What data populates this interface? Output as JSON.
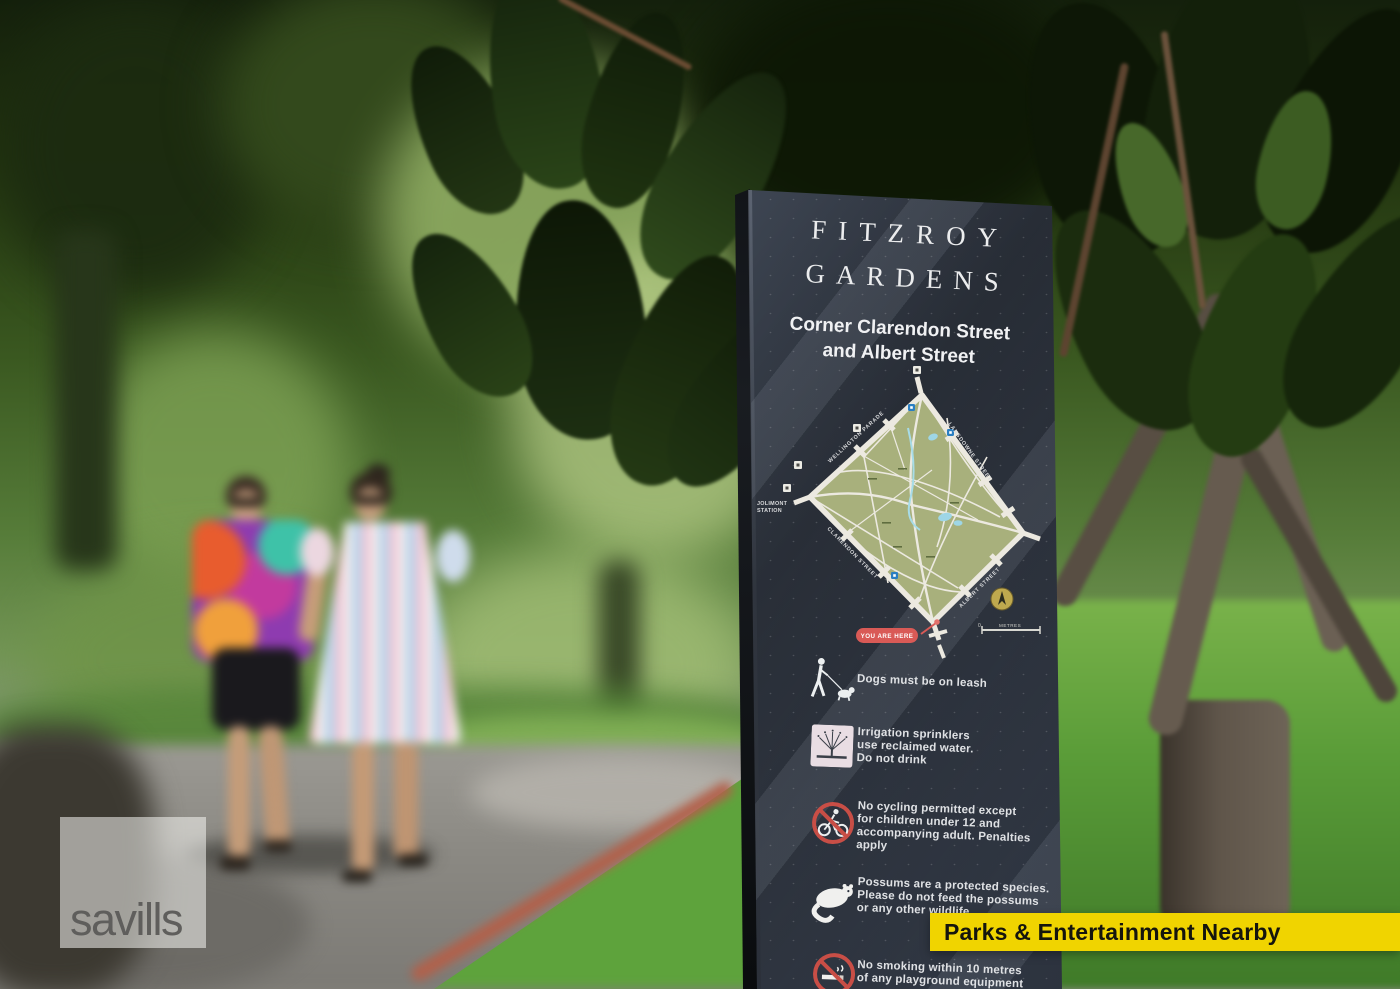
{
  "banner": {
    "label": "Parks & Entertainment Nearby",
    "bg_color": "#F0D400",
    "text_color": "#15150D"
  },
  "watermark": {
    "label": "savills"
  },
  "sign": {
    "panel_color": "#3E4654",
    "title_line1": "FITZROY",
    "title_line2": "GARDENS",
    "subtitle_line1": "Corner Clarendon Street",
    "subtitle_line2": "and Albert Street",
    "map": {
      "park_fill_color": "#A8B07C",
      "path_color": "#ECE9E0",
      "marker_color": "#D95A56",
      "street_labels": {
        "top_left": "WELLINGTON PARADE",
        "top_right": "LANSDOWNE STREET",
        "bottom_left": "CLARENDON STREET",
        "bottom_right": "ALBERT STREET"
      },
      "station_line1": "JOLIMONT",
      "station_line2": "STATION",
      "you_are_here_label": "YOU ARE HERE",
      "scale_zero": "0",
      "scale_label": "METRES"
    },
    "rules": [
      {
        "icon": "dog-walker-icon",
        "text": "Dogs must be on leash"
      },
      {
        "icon": "sprinkler-icon",
        "text": "Irrigation sprinklers\nuse reclaimed water.\nDo not drink"
      },
      {
        "icon": "no-cycling-icon",
        "text": "No cycling permitted except\nfor children under 12 and\naccompanying adult. Penalties apply"
      },
      {
        "icon": "possum-icon",
        "text": "Possums are a protected species.\nPlease do not feed the possums\nor any other wildlife"
      },
      {
        "icon": "no-smoking-icon",
        "text": "No smoking within 10 metres\nof any playground equipment"
      }
    ]
  }
}
